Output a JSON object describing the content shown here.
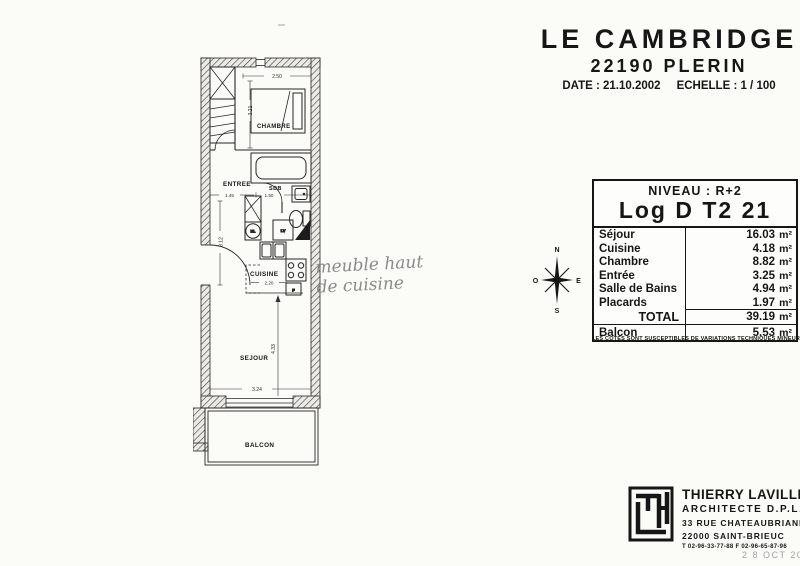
{
  "title_block": {
    "title": "LE CAMBRIDGE",
    "subtitle": "22190 PLERIN",
    "date_label": "DATE : 21.10.2002",
    "scale_label": "ECHELLE : 1 / 100"
  },
  "unit_table": {
    "niveau": "NIVEAU : R+2",
    "log": "Log D T2 21",
    "unit": "m²",
    "rows": [
      {
        "label": "Séjour",
        "value": "16.03"
      },
      {
        "label": "Cuisine",
        "value": "4.18"
      },
      {
        "label": "Chambre",
        "value": "8.82"
      },
      {
        "label": "Entrée",
        "value": "3.25"
      },
      {
        "label": "Salle de Bains",
        "value": "4.94"
      },
      {
        "label": "Placards",
        "value": "1.97"
      }
    ],
    "total_label": "TOTAL",
    "total_value": "39.19",
    "balcon_label": "Balcon",
    "balcon_value": "5.53",
    "footnote": "LES COTES SONT SUSCEPTIBLES DE VARIATIONS TECHNIQUES MINEURES"
  },
  "compass": {
    "n": "N",
    "s": "S",
    "e": "E",
    "o": "O"
  },
  "plan": {
    "labels": {
      "chambre": "CHAMBRE",
      "entree": "ENTREE",
      "sdb": "SDB",
      "cuisine": "CUISINE",
      "sejour": "SEJOUR",
      "balcon": "BALCON"
    },
    "dims": {
      "chambre_width": "2.50",
      "chambre_height": "3.21",
      "entree_width": "1.45",
      "sdb_width": "1.50",
      "entree_height": "3.12",
      "cuisine_width": "2.20",
      "sejour_height": "4.33",
      "sejour_width": "3.24"
    },
    "appliances": {
      "washer": "ML",
      "dishwasher": "LV",
      "fridge": "F"
    }
  },
  "annotation": {
    "line1": "meuble haut",
    "line2": "de cuisine"
  },
  "architect": {
    "name": "THIERRY LAVILLE",
    "title": "ARCHITECTE D.P.L.G.",
    "address1": "33 RUE CHATEAUBRIAND",
    "address2": "22000 SAINT-BRIEUC",
    "phone": "T 02-96-33-77-88   F 02-96-65-87-96"
  },
  "stamp": {
    "date": "2 8 OCT 2002"
  }
}
